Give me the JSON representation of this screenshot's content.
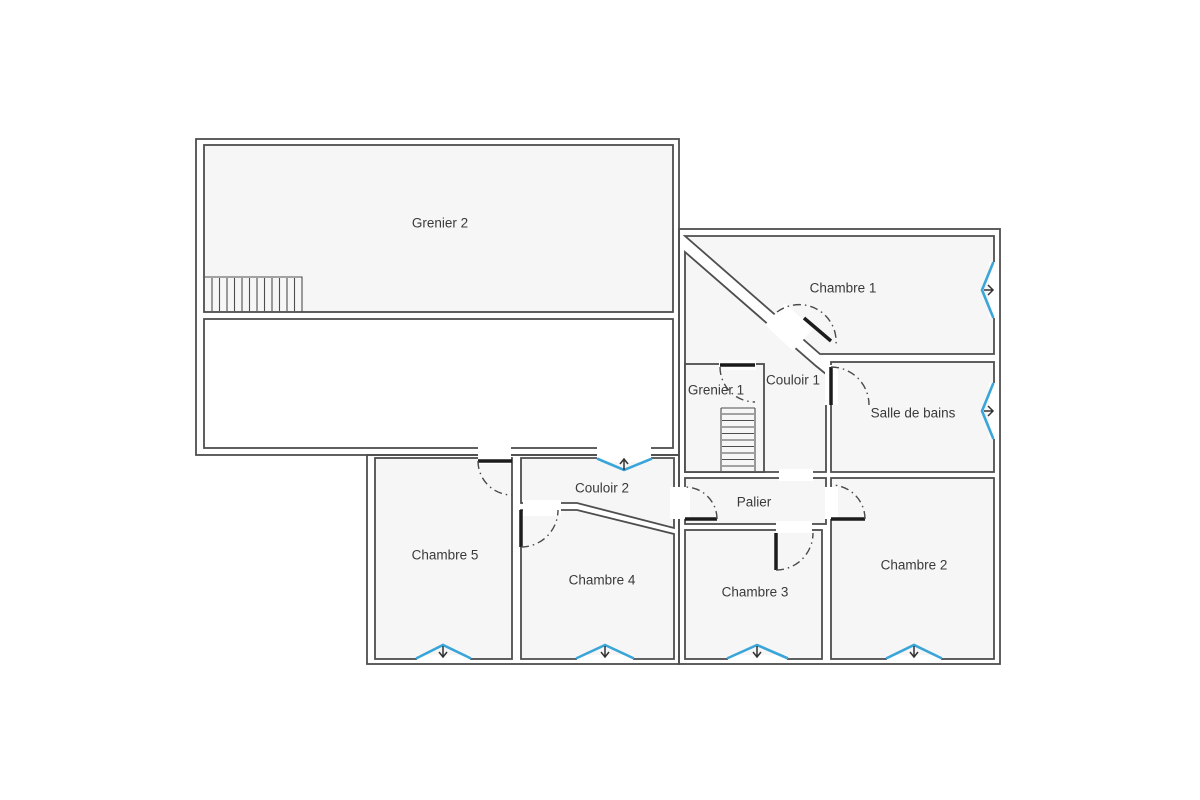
{
  "plan": {
    "rooms": [
      {
        "id": "grenier-2",
        "label": "Grenier 2"
      },
      {
        "id": "chambre-1",
        "label": "Chambre 1"
      },
      {
        "id": "couloir-1",
        "label": "Couloir 1"
      },
      {
        "id": "grenier-1",
        "label": "Grenier 1"
      },
      {
        "id": "salle-de-bains",
        "label": "Salle de bains"
      },
      {
        "id": "palier",
        "label": "Palier"
      },
      {
        "id": "chambre-2",
        "label": "Chambre 2"
      },
      {
        "id": "chambre-3",
        "label": "Chambre 3"
      },
      {
        "id": "chambre-4",
        "label": "Chambre 4"
      },
      {
        "id": "chambre-5",
        "label": "Chambre 5"
      },
      {
        "id": "couloir-2",
        "label": "Couloir 2"
      }
    ],
    "colors": {
      "wall": "#4e4e4e",
      "room_fill": "#f6f6f6",
      "window_accent": "#3aa5d8",
      "label_text": "#3a3a3a",
      "background": "#ffffff"
    }
  }
}
